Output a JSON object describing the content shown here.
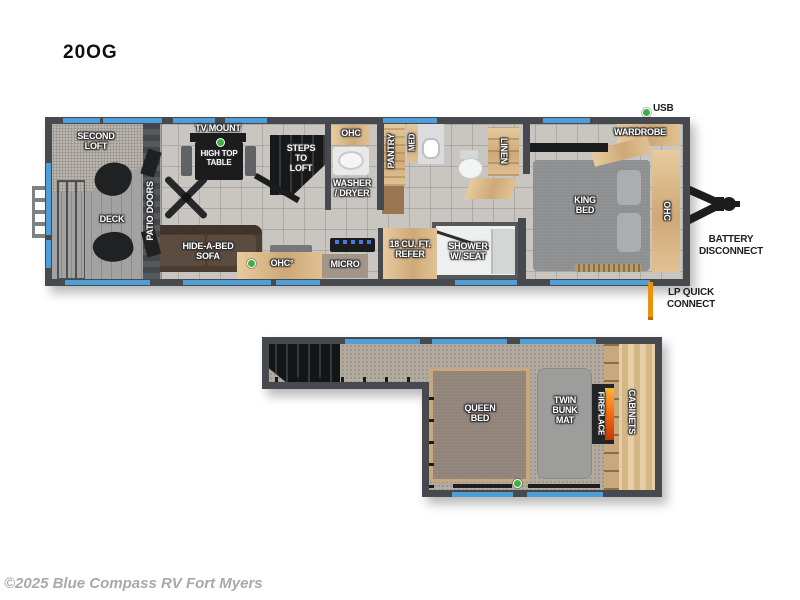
{
  "title": "20OG",
  "copyright": "©2025 Blue Compass RV Fort Myers",
  "colors": {
    "wall": "#46494d",
    "window_blue": "#4f9ed8",
    "wood": "#d6ba90",
    "led_green": "#3cb043",
    "lp_orange": "#e8920e",
    "fire_orange": "#f46a12"
  },
  "main_floor": {
    "labels": {
      "second_loft": "SECOND\nLOFT",
      "deck": "DECK",
      "patio_doors": "PATIO DOORS",
      "tv_mount": "TV MOUNT",
      "high_top_table": "HIGH TOP\nTABLE",
      "steps_to_loft": "STEPS\nTO\nLOFT",
      "ohc_hall": "OHC",
      "washer_dryer": "WASHER\n/ DRYER",
      "pantry": "PANTRY",
      "med": "MED",
      "linen": "LINEN",
      "hide_a_bed_sofa": "HIDE-A-BED\nSOFA",
      "ohc_kitchen": "OHC°",
      "micro": "MICRO",
      "refer": "18 CU. FT.\nREFER",
      "shower": "SHOWER\nW/ SEAT",
      "king_bed": "KING\nBED",
      "wardrobe": "WARDROBE",
      "ohc_bedroom": "OHC"
    },
    "exterior_labels": {
      "usb": "USB",
      "battery_disconnect": "BATTERY\nDISCONNECT",
      "lp_quick_connect": "LP QUICK\nCONNECT"
    }
  },
  "loft_floor": {
    "labels": {
      "queen_bed": "QUEEN\nBED",
      "twin_bunk_mat": "TWIN\nBUNK\nMAT",
      "fireplace": "FIREPLACE",
      "cabinets": "CABINETS"
    }
  }
}
